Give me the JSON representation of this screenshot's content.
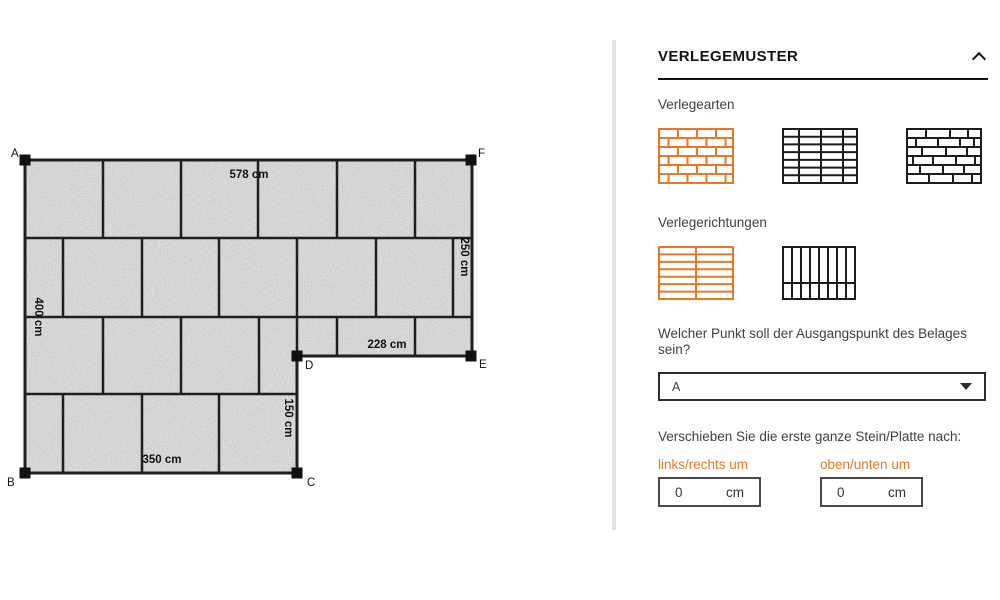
{
  "diagram": {
    "corners": {
      "a": "A",
      "b": "B",
      "c": "C",
      "d": "D",
      "e": "E",
      "f": "F"
    },
    "dimensions": {
      "top": "578 cm",
      "right": "250 cm",
      "left": "400 cm",
      "inner_top": "228 cm",
      "inner_right": "150 cm",
      "bottom": "350 cm"
    }
  },
  "panel": {
    "title": "VERLEGEMUSTER",
    "collapse_icon": "chevron-up",
    "verlegearten": {
      "label": "Verlegearten",
      "options": [
        {
          "id": "running-bond",
          "selected": true
        },
        {
          "id": "stack-bond",
          "selected": false
        },
        {
          "id": "wild-bond",
          "selected": false
        }
      ]
    },
    "verlegerichtungen": {
      "label": "Verlegerichtungen",
      "options": [
        {
          "id": "horizontal",
          "selected": true
        },
        {
          "id": "vertical",
          "selected": false
        }
      ]
    },
    "origin": {
      "question": "Welcher Punkt soll der Ausgangspunkt des Belages sein?",
      "selected_value": "A",
      "icon": "dropdown-arrow"
    },
    "shift": {
      "label": "Verschieben Sie die erste ganze Stein/Platte nach:",
      "fields": [
        {
          "label": "links/rechts um",
          "value": "0",
          "unit": "cm"
        },
        {
          "label": "oben/unten um",
          "value": "0",
          "unit": "cm"
        }
      ]
    }
  },
  "colors": {
    "accent": "#ee7623",
    "line": "#1f1f1f",
    "tile_gray": "#a8a8a8",
    "divider": "#e4e4e4"
  }
}
